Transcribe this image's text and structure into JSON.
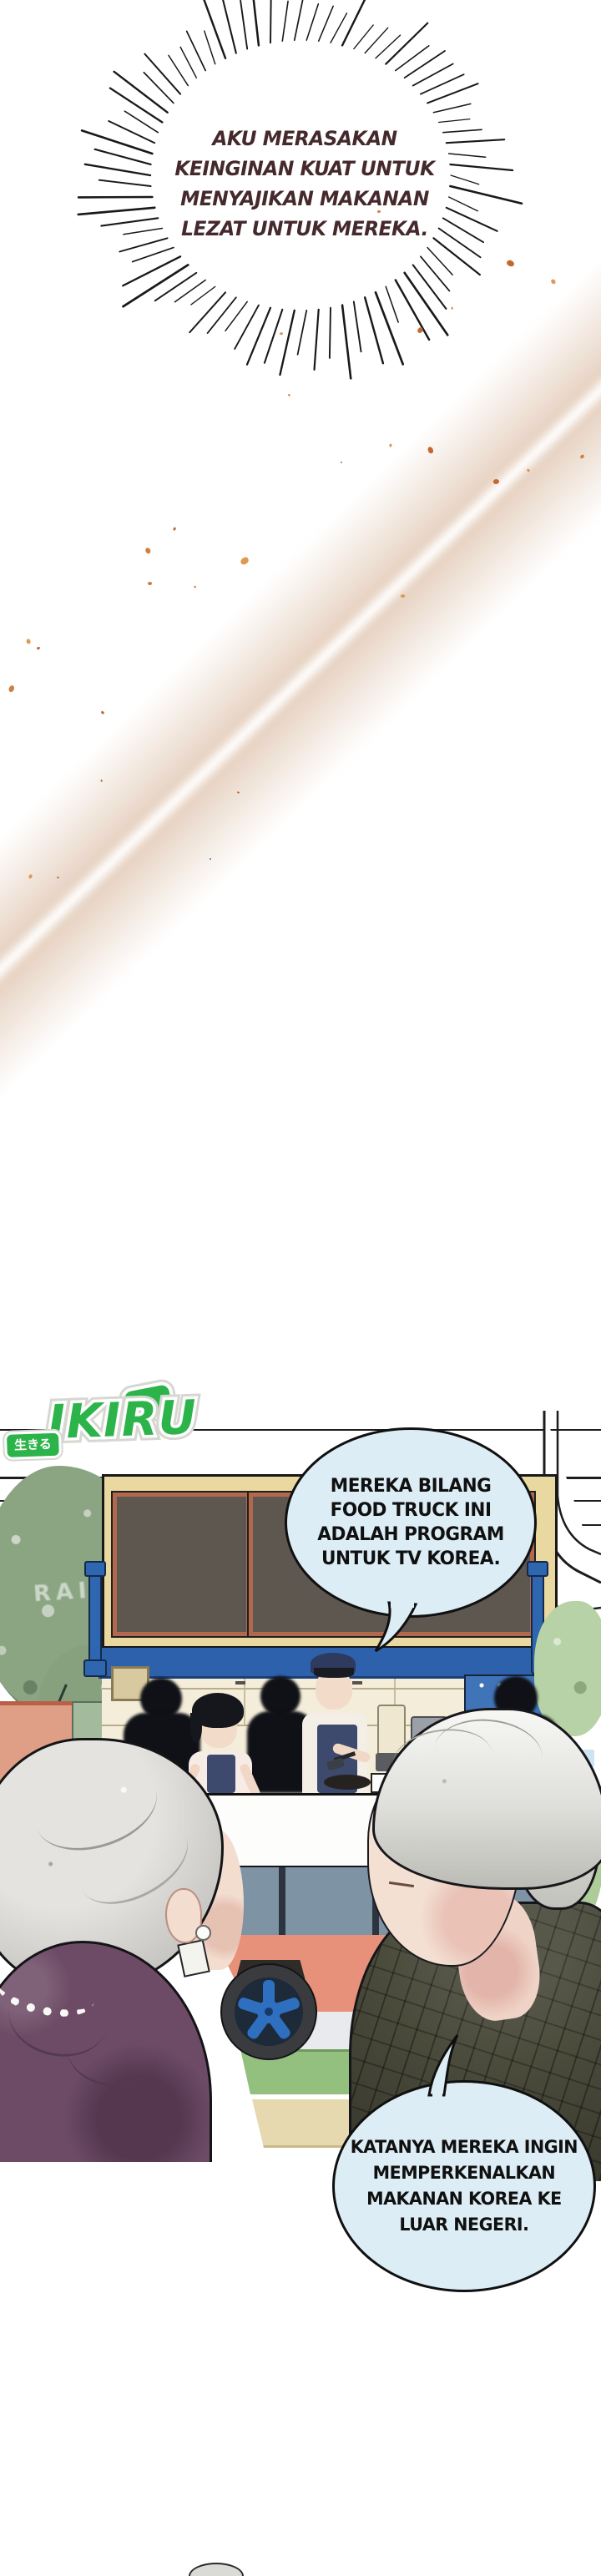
{
  "burst": {
    "text": "AKU MERASAKAN\nKEINGINAN KUAT UNTUK\nMENYAJIKAN MAKANAN\nLEZAT UNTUK MEREKA.",
    "text_color": "#45292c"
  },
  "logo": {
    "badge_text": "生きる",
    "word": "IKIRU",
    "green": "#2cb44a"
  },
  "scene": {
    "sign_text": "RAI"
  },
  "bubbles": {
    "fill": "#ddedf5",
    "tv_program": "MEREKA BILANG\nFOOD TRUCK INI\nADALAH PROGRAM\nUNTUK TV KOREA.",
    "introduce": "KATANYA MEREKA INGIN\nMEMPERKENALKAN\nMAKANAN KOREA KE\nLUAR NEGERI."
  },
  "colors": {
    "ink": "#141414",
    "burst_text": "#45292c",
    "speckle_orange": "#cf7f3f",
    "logo_green": "#2cb44a",
    "tree_green": "#8ba583",
    "truck_frame_cream": "#e9d89f",
    "chalkboard_gray": "#5d5750",
    "board_frame_rust": "#b2684f",
    "truck_blue": "#2e61ac",
    "salmon_lower": "#e8917a",
    "stripe_green": "#93c07e",
    "stripe_tan": "#e6d9b0",
    "wheel_blue": "#2f6fc0",
    "apron_navy": "#3d4a6e",
    "dress_plum": "#6d4b66",
    "plaid_olive": "#4b4b3c"
  }
}
